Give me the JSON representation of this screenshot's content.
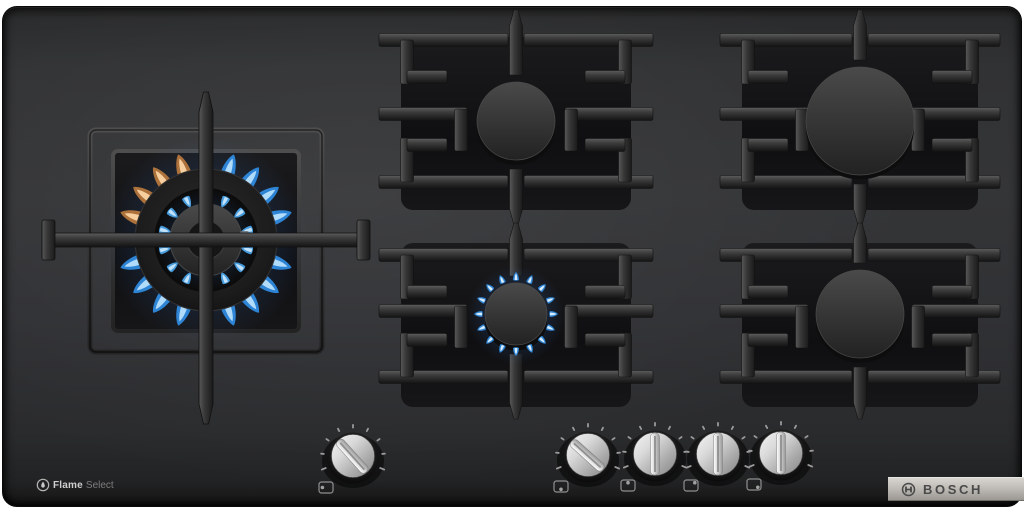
{
  "branding": {
    "bosch_label": "BOSCH",
    "feature_bold": "Flame",
    "feature_light": "Select",
    "feature_icon": "flame-in-circle-icon",
    "bosch_icon": "bosch-armature-icon"
  },
  "colors": {
    "surface": "#323336",
    "glass": "#121214",
    "flame-blue": "#2f8ade",
    "flame-blue-light": "#bfe4ff",
    "flame-orange": "#b5763d",
    "flame-orange-light": "#ffd9a8",
    "knob-silver": "#d9d9d9",
    "logo-bar": "#beb9b3",
    "logo-text": "#4a4a4a"
  },
  "burners": [
    {
      "id": "left-wok",
      "size": "large wok",
      "state": "lit-high"
    },
    {
      "id": "top-middle",
      "size": "medium",
      "state": "off"
    },
    {
      "id": "top-right",
      "size": "large",
      "state": "off"
    },
    {
      "id": "bottom-middle",
      "size": "small",
      "state": "lit-simmer"
    },
    {
      "id": "bottom-right",
      "size": "medium",
      "state": "off"
    }
  ],
  "knobs": [
    {
      "id": "knob-left-wok",
      "controls": "left-wok",
      "state": "on",
      "rotation_deg": -42,
      "position_icon": "dot-left"
    },
    {
      "id": "knob-bottom-middle",
      "controls": "bottom-middle",
      "state": "on",
      "rotation_deg": -48,
      "position_icon": "dot-bottom"
    },
    {
      "id": "knob-top-middle",
      "controls": "top-middle",
      "state": "off",
      "rotation_deg": 0,
      "position_icon": "dot-top"
    },
    {
      "id": "knob-top-right",
      "controls": "top-right",
      "state": "off",
      "rotation_deg": 0,
      "position_icon": "dot-top-right"
    },
    {
      "id": "knob-bottom-right",
      "controls": "bottom-right",
      "state": "off",
      "rotation_deg": 0,
      "position_icon": "dot-bottom-right"
    }
  ]
}
